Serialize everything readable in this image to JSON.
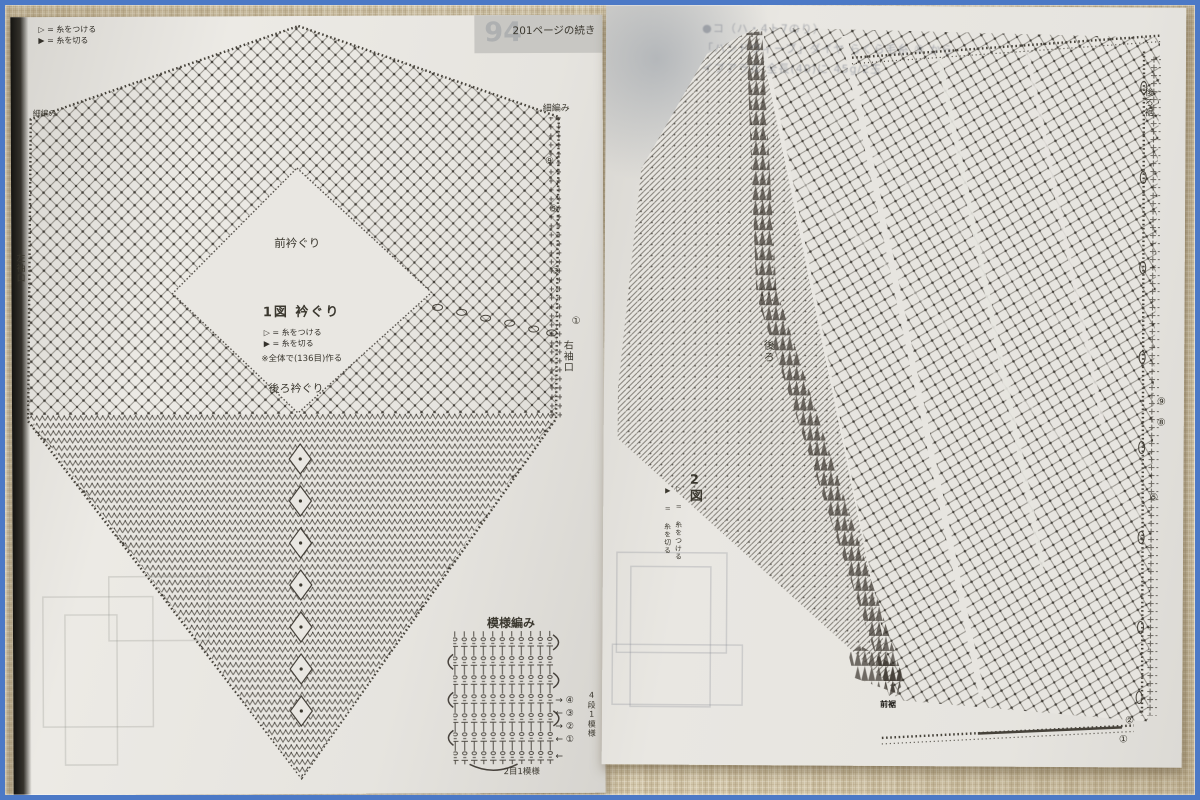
{
  "colors": {
    "frame_blue": "#4c79c6",
    "fabric_beige": "#d9cdb0",
    "paper": "#e7e5e0",
    "ink": "#46423a"
  },
  "left_page": {
    "top_note": "201ページの続き",
    "ghost_page_number": "94",
    "legend": [
      "▷ = 糸をつける",
      "▶ = 糸を切る"
    ],
    "labels": {
      "single_crochet_left": "細編み",
      "single_crochet_right": "細編み",
      "front_neckline": "前衿ぐり",
      "figure1_title": "1図 衿ぐり",
      "figure1_note": "※全体で(136目)作る",
      "back_neckline": "後ろ衿ぐり",
      "left_cuff": "左袖口",
      "right_cuff": "右袖口"
    },
    "figure1_legend": [
      "▷ = 糸をつける",
      "▶ = 糸を切る"
    ],
    "row_markers": [
      "⑨",
      "⑤",
      "③",
      "①"
    ],
    "swatch": {
      "title": "模様編み",
      "arrow_rows": [
        "→ ④",
        "← ③",
        "→ ②",
        "← ①"
      ],
      "bottom_arrow": "←",
      "rows_label": "4段1模様",
      "stitches_label": "2目1模様"
    }
  },
  "right_page": {
    "ghost_lines": [
      "●コ（ハ・4ト7のり）",
      "「ハンドウィーブ」ダイヤ らくら毛糸 ⑨ から",
      "イブアラル 全長(40)に 45g/2玉"
    ],
    "labels": {
      "back": "後ろ",
      "figure2_title": "2図",
      "back_hem": "後ろ裾",
      "front_hem": "前裾"
    },
    "figure2_legend": [
      "▷ = 糸をつける",
      "▶ = 糸を切る"
    ],
    "row_markers": [
      "⑨",
      "⑧",
      "⑤",
      "②",
      "①"
    ]
  }
}
